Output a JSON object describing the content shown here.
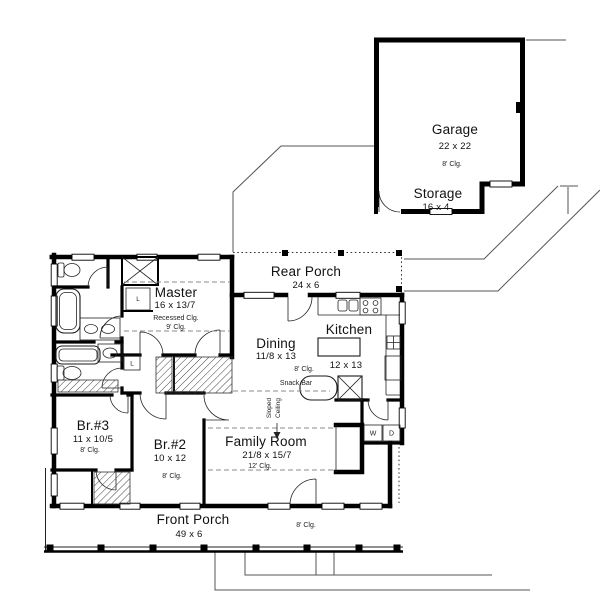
{
  "rooms": {
    "garage": {
      "name": "Garage",
      "dims": "22 x 22",
      "clg": "8' Clg."
    },
    "storage": {
      "name": "Storage",
      "dims": "16 x 4"
    },
    "rear_porch": {
      "name": "Rear Porch",
      "dims": "24 x 6"
    },
    "master": {
      "name": "Master",
      "dims": "16 x 13/7",
      "note": "Recessed Clg.",
      "clg": "9' Clg."
    },
    "dining": {
      "name": "Dining",
      "dims": "11/8 x 13",
      "clg": "8' Clg."
    },
    "kitchen": {
      "name": "Kitchen",
      "dims": "12 x 13"
    },
    "family_room": {
      "name": "Family Room",
      "dims": "21/8 x 15/7",
      "clg": "12' Clg."
    },
    "br3": {
      "name": "Br.#3",
      "dims": "11 x 10/5",
      "clg": "8' Clg."
    },
    "br2": {
      "name": "Br.#2",
      "dims": "10 x 12",
      "clg": "8' Clg."
    },
    "front_porch": {
      "name": "Front Porch",
      "dims": "49 x 6",
      "clg": "8' Clg."
    }
  },
  "labels": {
    "snack_bar": "Snack Bar",
    "sloped": "Sloped",
    "ceiling": "Ceiling",
    "washer": "W",
    "dryer": "D",
    "linen": "L"
  },
  "colors": {
    "wall": "#000000",
    "background": "#ffffff",
    "site_line": "#555555"
  }
}
